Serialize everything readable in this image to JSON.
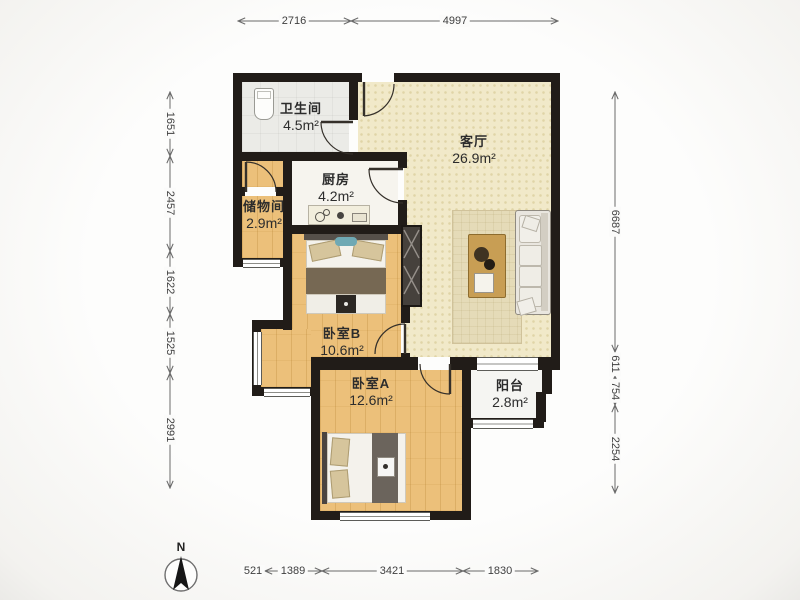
{
  "title": "二室一厅户型图 (2-bedroom floor plan)",
  "rooms": {
    "bathroom": {
      "name": "卫生间",
      "area": "4.5m²"
    },
    "kitchen": {
      "name": "厨房",
      "area": "4.2m²"
    },
    "storage": {
      "name": "储物间",
      "area": "2.9m²"
    },
    "living": {
      "name": "客厅",
      "area": "26.9m²"
    },
    "bedroom_b": {
      "name": "卧室B",
      "area": "10.6m²"
    },
    "bedroom_a": {
      "name": "卧室A",
      "area": "12.6m²"
    },
    "balcony": {
      "name": "阳台",
      "area": "2.8m²"
    }
  },
  "dimensions": {
    "top": [
      "2716",
      "4997"
    ],
    "left": [
      "1651",
      "2457",
      "1622",
      "1525",
      "2991"
    ],
    "right": [
      "6687",
      "611",
      "754",
      "2254"
    ],
    "bottom": [
      "521",
      "1389",
      "3421",
      "1830"
    ]
  },
  "compass": {
    "label": "N"
  },
  "colors": {
    "wall": "#211c18",
    "wood_floor": "#ecc07a",
    "living_floor": "#f1e9c9",
    "bath_floor": "#ebebe7",
    "kitchen_floor": "#f6f4ee",
    "balcony_floor": "#f5f5f2",
    "rug": "#e5dbb8",
    "sofa": "#e9e6df",
    "accent_pillow": "#6fa9b4",
    "dimension_text": "#3f3f3f"
  }
}
